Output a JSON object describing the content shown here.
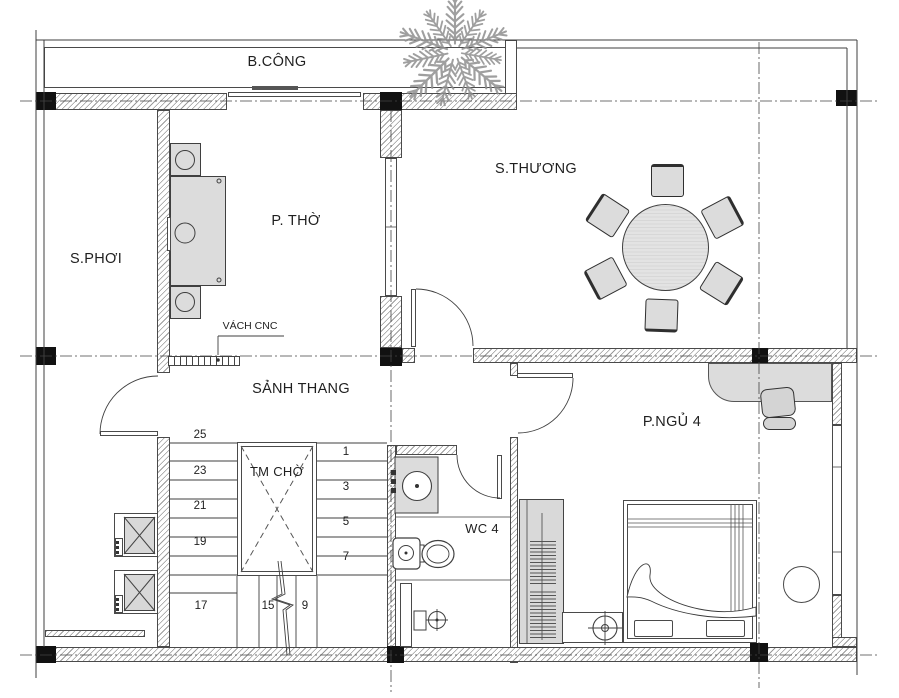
{
  "rooms": {
    "balcony": "B.CÔNG",
    "drying": "S.PHƠI",
    "worship": "P. THỜ",
    "terrace": "S.THƯƠNG",
    "stair_hall": "SẢNH THANG",
    "bedroom": "P.NGỦ 4",
    "wc": "WC 4"
  },
  "features": {
    "elevator_shaft": "TM CHỜ",
    "cnc_partition": "VÁCH CNC"
  },
  "stairs": {
    "left": [
      "25",
      "23",
      "21",
      "19"
    ],
    "landing": "17",
    "right": [
      "1",
      "3",
      "5",
      "7"
    ],
    "lower": [
      "15",
      "9"
    ]
  },
  "colors": {
    "line": "#3f3f3f",
    "hatch": "#9a9a9a",
    "furniture_fill": "#dcdcdc",
    "column_fill": "#111111",
    "tree": "#8f8f8f"
  }
}
